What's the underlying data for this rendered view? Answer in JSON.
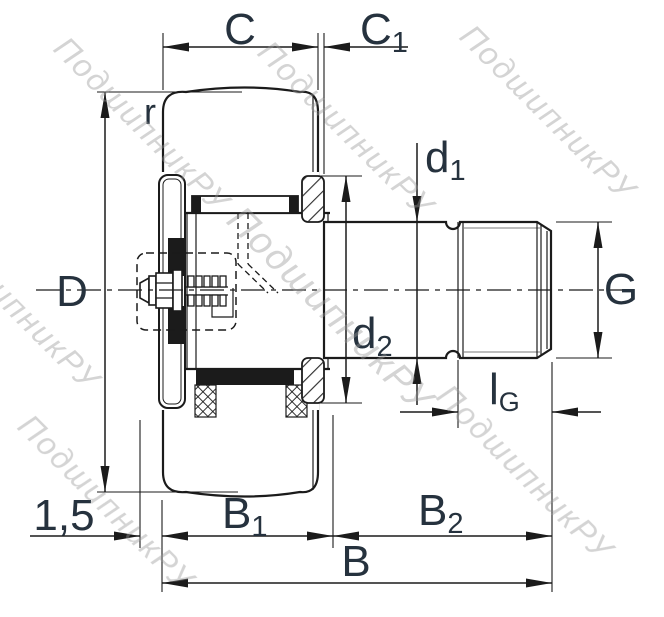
{
  "labels": {
    "c": "C",
    "c1_main": "C",
    "c1_sub": "1",
    "r": "r",
    "d_outer": "D",
    "d1_main": "d",
    "d1_sub": "1",
    "d2_main": "d",
    "d2_sub": "2",
    "g": "G",
    "lg_main": "l",
    "lg_sub": "G",
    "b1_main": "B",
    "b1_sub": "1",
    "b2_main": "B",
    "b2_sub": "2",
    "b": "B",
    "chamfer": "1,5"
  },
  "watermark": {
    "text": "ПодшипникРУ",
    "color": "#9a9a9a"
  },
  "colors": {
    "line": "#1b1b1b",
    "label": "#26323e",
    "watermark": "#9a9a9a",
    "thread_root": "#787878",
    "background": "#ffffff"
  }
}
